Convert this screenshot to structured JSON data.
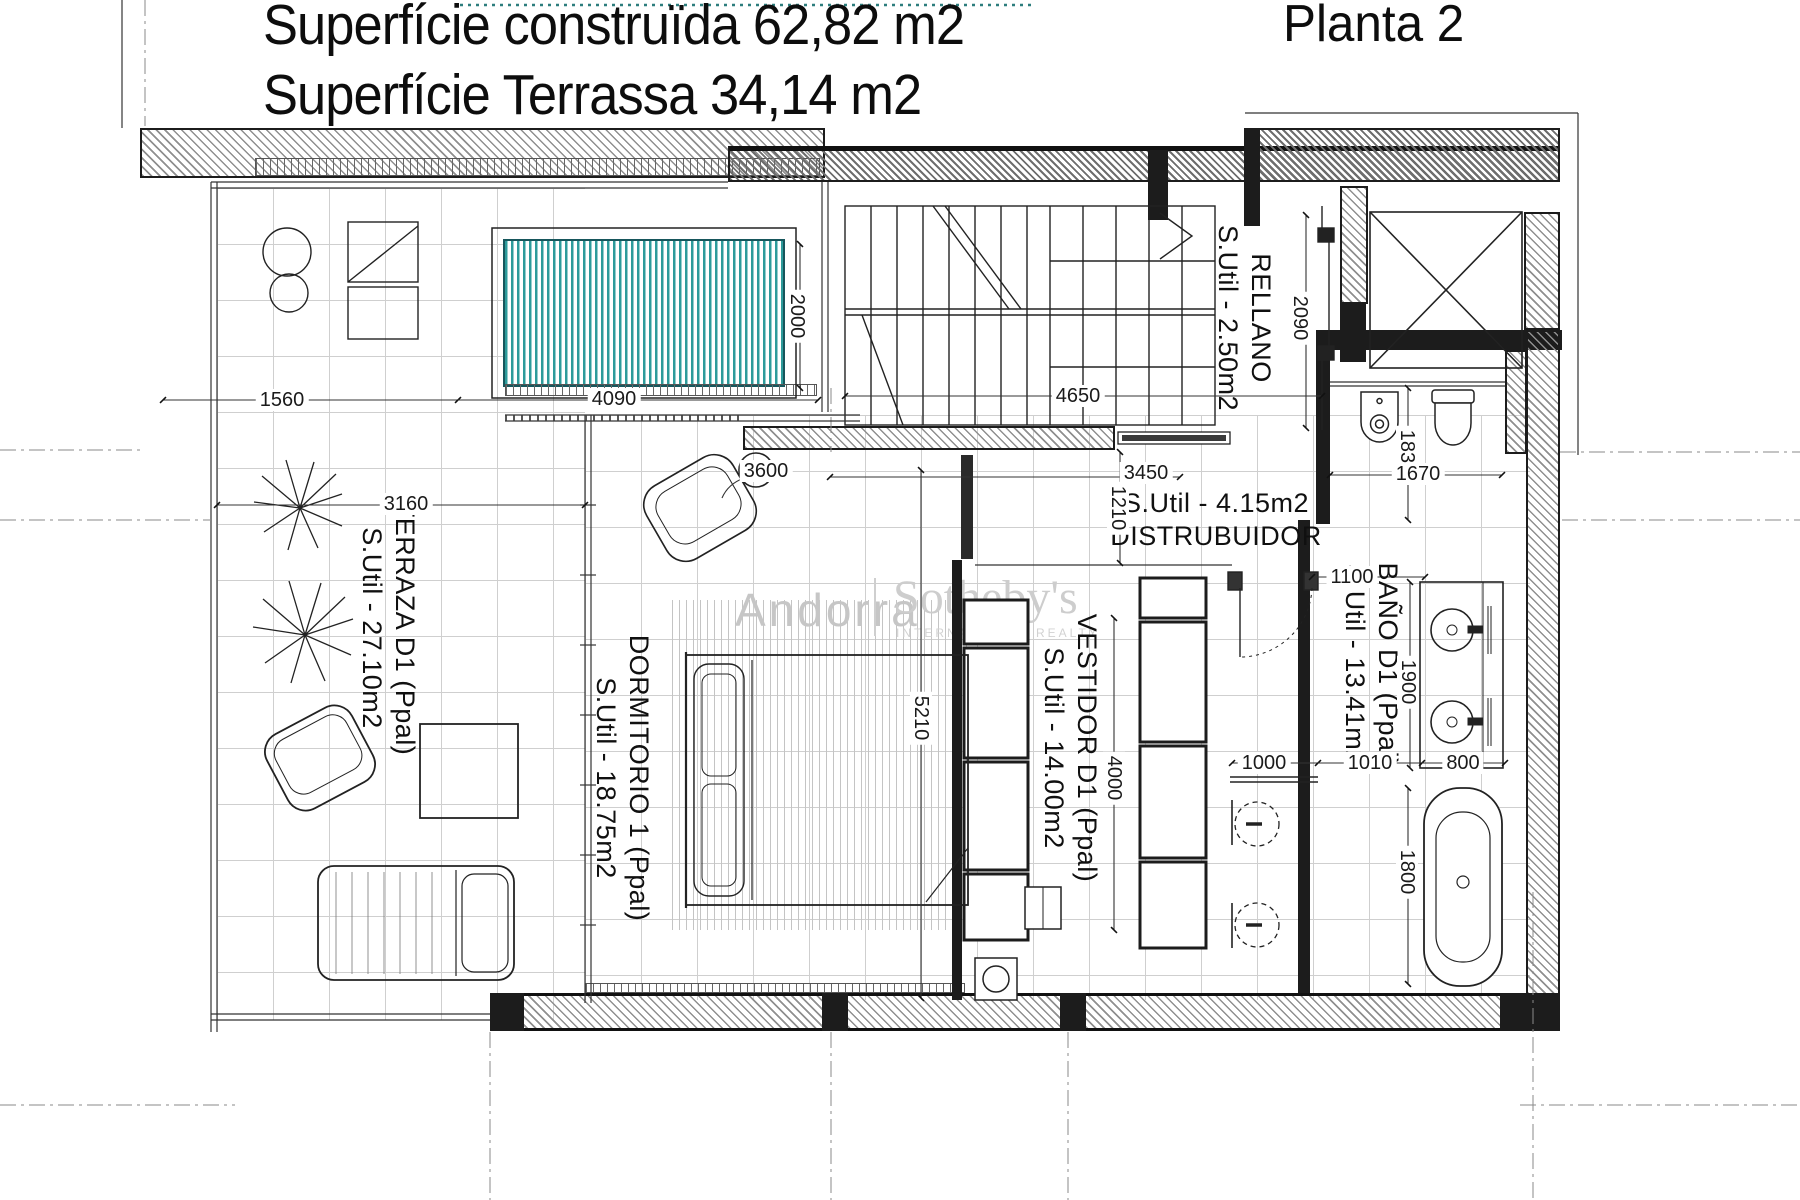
{
  "header": {
    "title_line1": "Superfície construïda 62,82 m2",
    "title_line2": "Superfície Terrassa 34,14 m2",
    "plan_label": "Planta 2"
  },
  "watermark": {
    "brand_left": "Andorra",
    "brand_right": "Sotheby's",
    "brand_sub": "INTERNATIONAL REALTY"
  },
  "rooms": {
    "terraza": {
      "name": "TERRAZA D1 (Ppal)",
      "area": "S.Util - 27.10m2"
    },
    "dormitorio": {
      "name": "DORMITORIO 1 (Ppal)",
      "area": "S.Util - 18.75m2"
    },
    "vestidor": {
      "name": "VESTIDOR D1 (Ppal)",
      "area": "S.Util - 14.00m2"
    },
    "bano": {
      "name": "BAÑO D1 (Ppal)",
      "area": "S.Util - 13.41m2"
    },
    "rellano": {
      "name": "RELLANO",
      "area": "S.Util - 2.50m2"
    },
    "distribuidor": {
      "name": "DISTRUBUIDOR",
      "area": "S.Util - 4.15m2"
    }
  },
  "dimensions": {
    "terrace_edge": "1560",
    "pool_width": "4090",
    "pool_depth": "2000",
    "stair_hall_width": "4650",
    "rellano_depth": "2090",
    "dorm_door_width": "3600",
    "terrace_width": "3160",
    "distribuidor_width": "3450",
    "distribuidor_depth": "1210",
    "aseo_depth": "1830",
    "aseo_width": "1670",
    "vestidor_door": "1100",
    "dorm_length": "5210",
    "vestidor_length": "4000",
    "vanity_length": "1900",
    "shower_width": "1000",
    "bath_walk_width": "1010",
    "tub_width": "800",
    "tub_length": "1800"
  },
  "colors": {
    "pool_stripe": "#2d9b9b",
    "wall_ink": "#1c1c1c",
    "hatch_gray": "#8f8f8f",
    "floor_grid": "#cfcfcf",
    "watermark_gray": "#c8c8c8"
  }
}
